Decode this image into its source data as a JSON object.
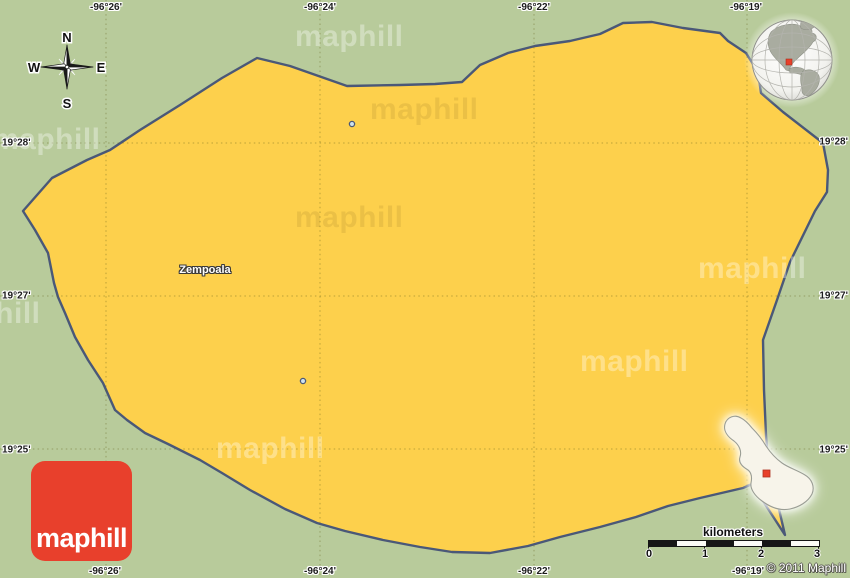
{
  "map": {
    "place_label": "Zempoala",
    "region": "Zempoala"
  },
  "coordinates": {
    "top": [
      "-96°26'",
      "-96°24'",
      "-96°22'",
      "-96°19'"
    ],
    "bottom": [
      "-96°26'",
      "-96°24'",
      "-96°22'",
      "-96°19'"
    ],
    "left": [
      "19°28'",
      "19°27'",
      "19°25'"
    ],
    "right": [
      "19°28'",
      "19°27'",
      "19°25'"
    ]
  },
  "compass": {
    "north": "N",
    "south": "S",
    "east": "E",
    "west": "W"
  },
  "scale_bar": {
    "label": "kilometers",
    "ticks": [
      "0",
      "1",
      "2",
      "3"
    ]
  },
  "watermark": {
    "text": "maphill"
  },
  "logo": {
    "text": "maphill"
  },
  "copyright": "© 2011 Maphill",
  "colors": {
    "background_green": "#b8cb9b",
    "area_yellow": "#fdd04c",
    "boundary_blue": "#4a5878",
    "logo_red": "#e8402c",
    "marker_red": "#e8402a",
    "inset_fill": "#f7f4ea"
  }
}
